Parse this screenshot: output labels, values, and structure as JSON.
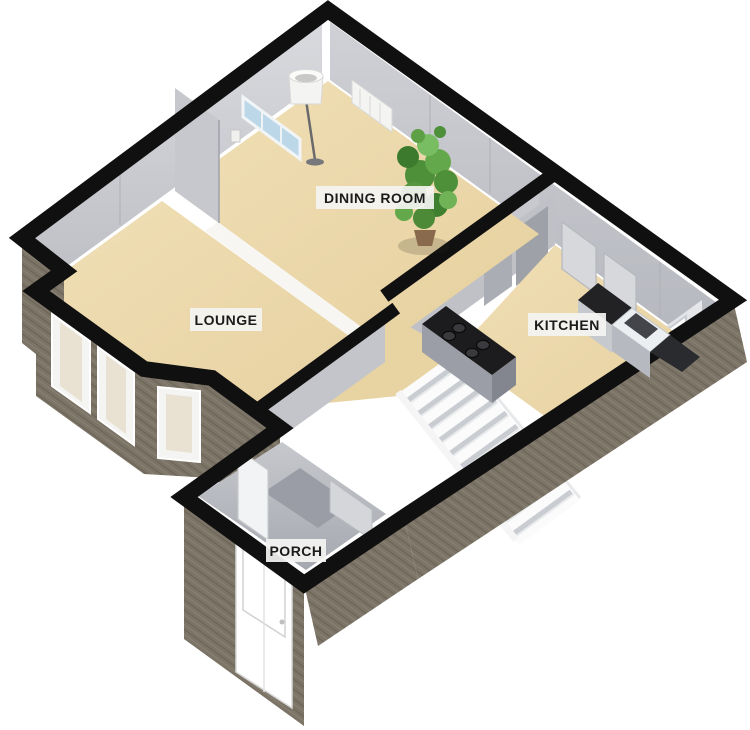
{
  "page": {
    "background": "#ffffff",
    "type": "3d-floorplan-render"
  },
  "floorplan": {
    "projection": "isometric-3d",
    "labels": {
      "dining": "DINING ROOM",
      "lounge": "LOUNGE",
      "kitchen": "KITCHEN",
      "porch": "PORCH"
    },
    "rooms": [
      {
        "name": "DINING ROOM"
      },
      {
        "name": "LOUNGE"
      },
      {
        "name": "KITCHEN"
      },
      {
        "name": "PORCH"
      }
    ],
    "features": [
      "floor-lamp",
      "wall-radiator",
      "window-blue",
      "potted-plant",
      "kitchen-hob-4-burners",
      "kitchen-sink",
      "kitchen-worktop",
      "staircase",
      "bay-windows",
      "angled-window",
      "front-door",
      "interior-door",
      "brick-exterior-walls"
    ],
    "colors": {
      "wall_top": "#101010",
      "brick": "#7c7466",
      "brick_line_dark": "#6b6456",
      "brick_line_light": "#8b8374",
      "floor": "#ecd9ab",
      "interior_wall_light": "#d7d9dd",
      "interior_wall_mid": "#c2c4c9",
      "stair_tread": "#fbfbfb",
      "stair_shadow": "#c9ccd1",
      "counter_top": "#1c1c1e",
      "plant_green": "#5da046",
      "label_bg": "#f4f4f2"
    }
  }
}
